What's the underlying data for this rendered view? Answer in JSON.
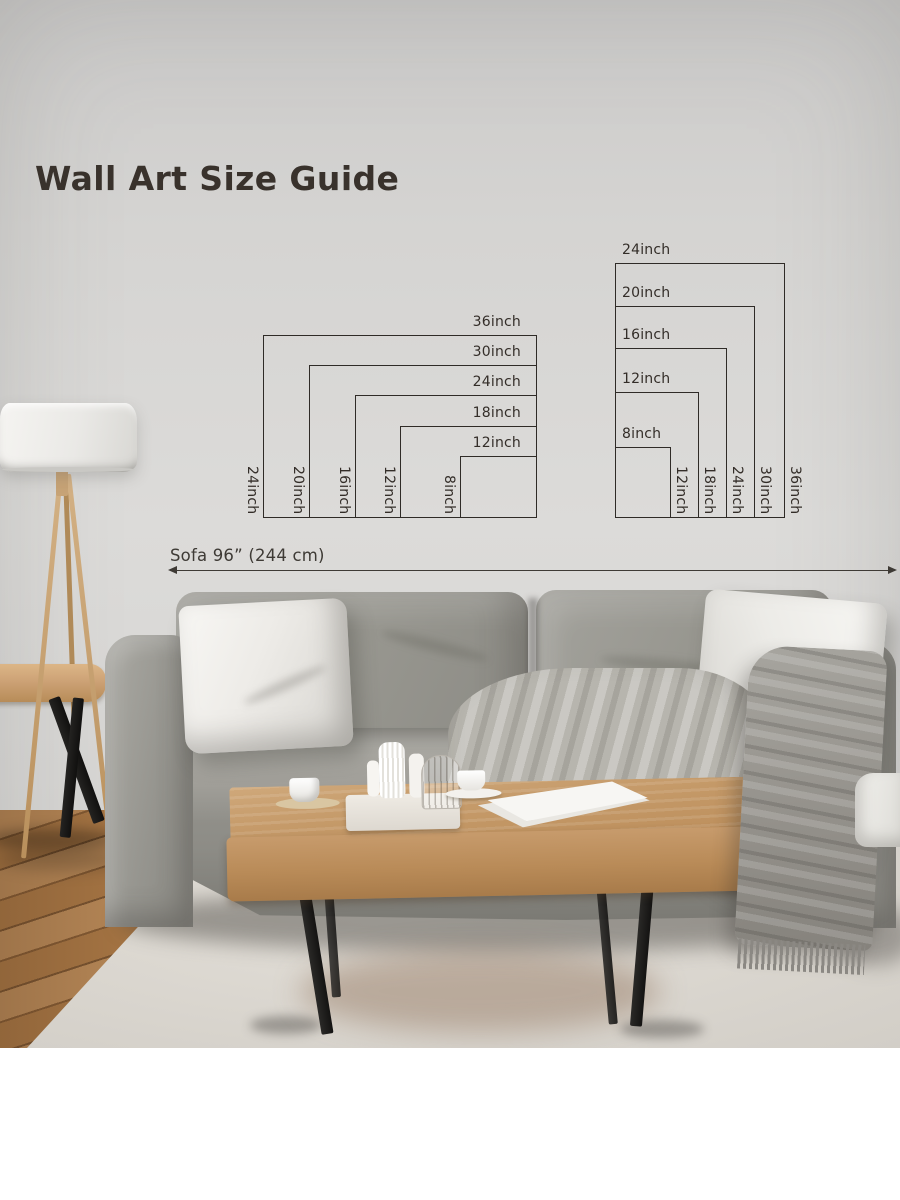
{
  "page": {
    "title": "Wall Art Size Guide"
  },
  "sofa_dimension": {
    "label": "Sofa 96” (244 cm)"
  },
  "size_guide": {
    "landscape": {
      "orientation": "landscape",
      "sizes": [
        {
          "width_label": "36inch",
          "height_label": "24inch",
          "width_in": 36,
          "height_in": 24
        },
        {
          "width_label": "30inch",
          "height_label": "20inch",
          "width_in": 30,
          "height_in": 20
        },
        {
          "width_label": "24inch",
          "height_label": "16inch",
          "width_in": 24,
          "height_in": 16
        },
        {
          "width_label": "18inch",
          "height_label": "12inch",
          "width_in": 18,
          "height_in": 12
        },
        {
          "width_label": "12inch",
          "height_label": "8inch",
          "width_in": 12,
          "height_in": 8
        }
      ]
    },
    "portrait": {
      "orientation": "portrait",
      "sizes": [
        {
          "width_label": "24inch",
          "height_label": "36inch",
          "width_in": 24,
          "height_in": 36
        },
        {
          "width_label": "20inch",
          "height_label": "30inch",
          "width_in": 20,
          "height_in": 30
        },
        {
          "width_label": "16inch",
          "height_label": "24inch",
          "width_in": 16,
          "height_in": 24
        },
        {
          "width_label": "12inch",
          "height_label": "18inch",
          "width_in": 12,
          "height_in": 18
        },
        {
          "width_label": "8inch",
          "height_label": "12inch",
          "width_in": 8,
          "height_in": 12
        }
      ]
    }
  },
  "palette": {
    "diagram_line": "#2f2b27",
    "diagram_text": "#332d28",
    "title_text": "#39322c",
    "wall": "#d6d5d3",
    "sofa_gray": "#98978f",
    "wood": "#c49a6a",
    "rug": "#dad6cf"
  },
  "scene": {
    "objects": [
      "tripod-floor-lamp",
      "wooden-side-stool",
      "gray-fabric-sofa",
      "white-throw-pillows",
      "gray-throw-blanket",
      "wooden-coffee-table",
      "white-tea-set",
      "white-area-rug",
      "wood-plank-floor",
      "white-armchair"
    ]
  }
}
